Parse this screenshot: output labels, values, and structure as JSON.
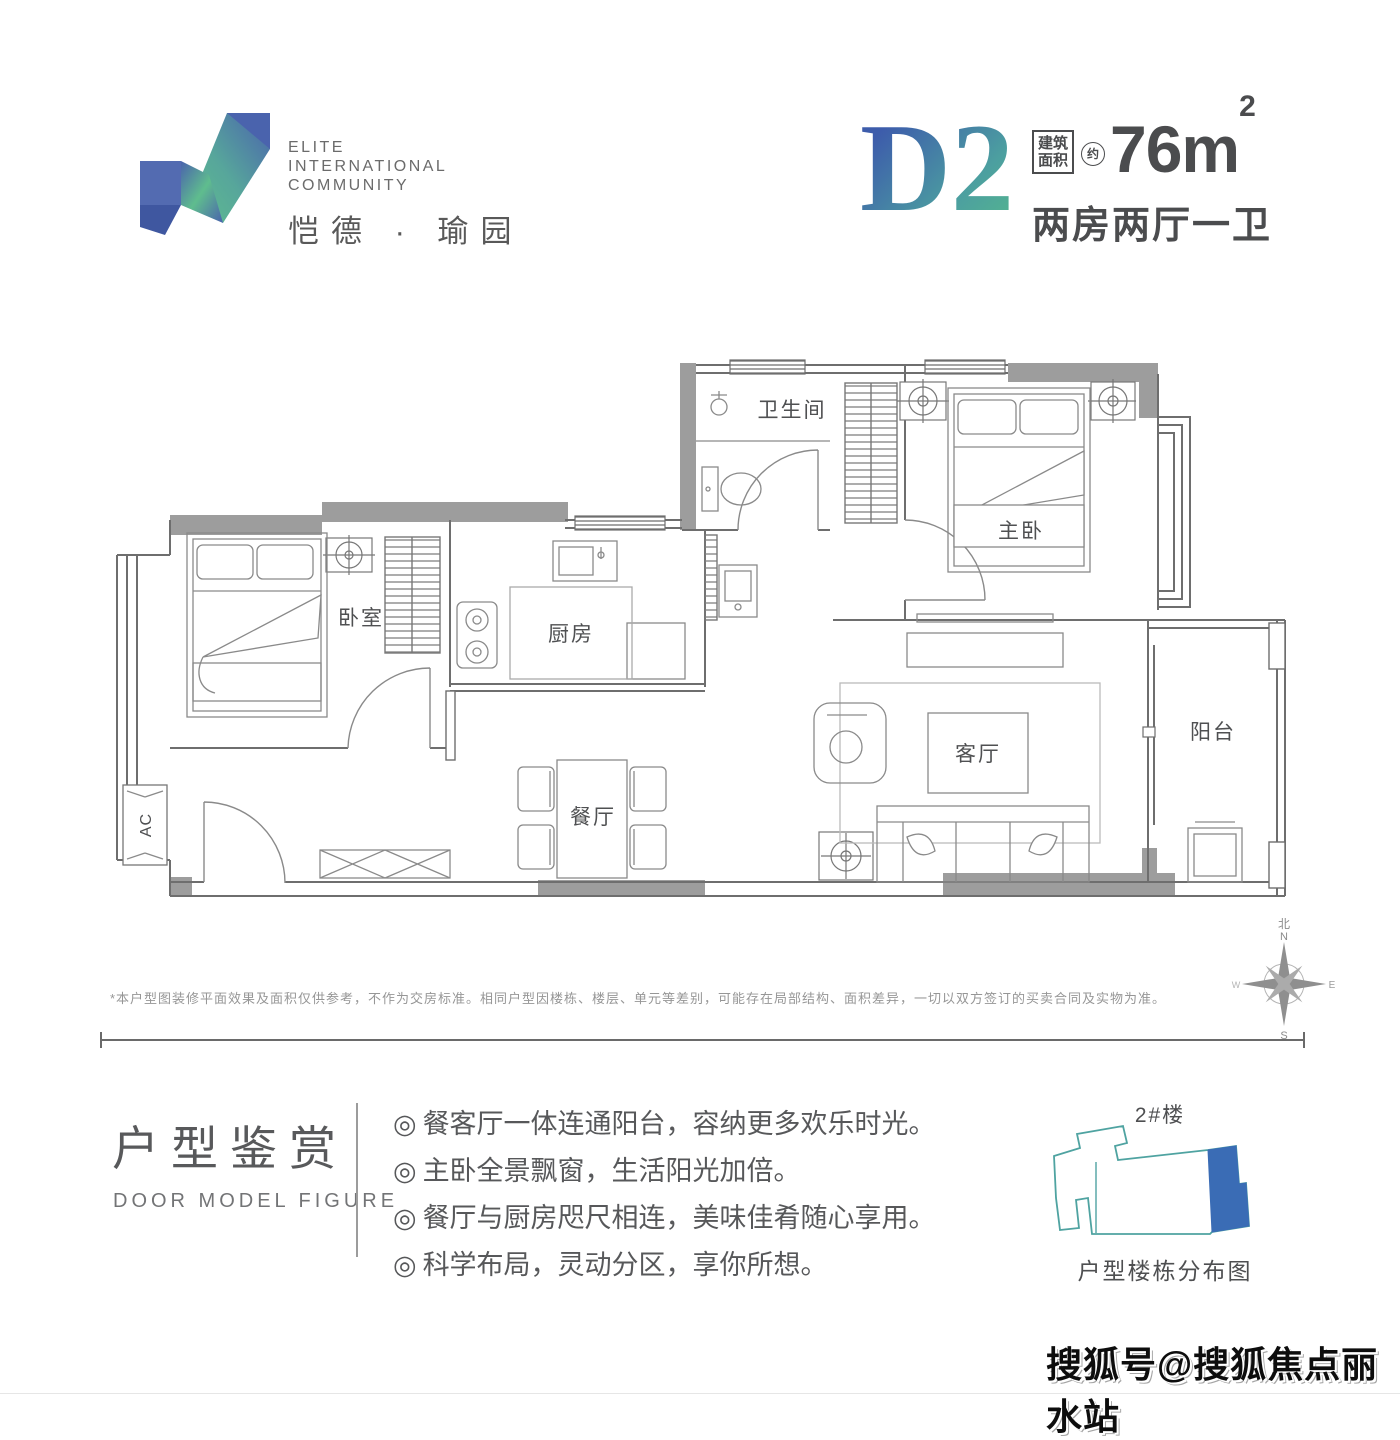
{
  "header": {
    "logo": {
      "line1": "ELITE",
      "line2": "INTERNATIONAL",
      "line3": "COMMUNITY",
      "chinese_name": "恺德 · 瑜园"
    },
    "unit": {
      "code": "D2",
      "area_label_line1": "建筑",
      "area_label_line2": "面积",
      "area_approx": "约",
      "area_value": "76m",
      "area_sup": "2",
      "layout": "两房两厅一卫"
    }
  },
  "floorplan": {
    "rooms": {
      "bathroom": "卫生间",
      "master_bedroom": "主卧",
      "bedroom": "卧室",
      "kitchen": "厨房",
      "living_room": "客厅",
      "dining_room": "餐厅",
      "balcony": "阳台",
      "ac": "AC"
    },
    "compass": {
      "north_cn": "北",
      "n": "N",
      "e": "E",
      "s": "S",
      "w": "W"
    },
    "disclaimer": "*本户型图装修平面效果及面积仅供参考，不作为交房标准。相同户型因楼栋、楼层、单元等差别，可能存在局部结构、面积差异，一切以双方签订的买卖合同及实物为准。"
  },
  "features": {
    "title_cn": "户型鉴赏",
    "title_en": "DOOR MODEL FIGURE",
    "bullet": "◎",
    "items": [
      "餐客厅一体连通阳台，容纳更多欢乐时光。",
      "主卧全景飘窗，生活阳光加倍。",
      "餐厅与厨房咫尺相连，美味佳肴随心享用。",
      "科学布局，灵动分区，享你所想。"
    ]
  },
  "building": {
    "label": "2#楼",
    "caption": "户型楼栋分布图"
  },
  "watermark": "搜狐号@搜狐焦点丽水站",
  "colors": {
    "accent_blue": "#3d5cab",
    "accent_green": "#55b88c",
    "wall_gray": "#9d9d9d",
    "text_dark": "#4b4c4e",
    "diagram_teal": "#4fa3a1",
    "diagram_blue": "#3a6cb5"
  }
}
